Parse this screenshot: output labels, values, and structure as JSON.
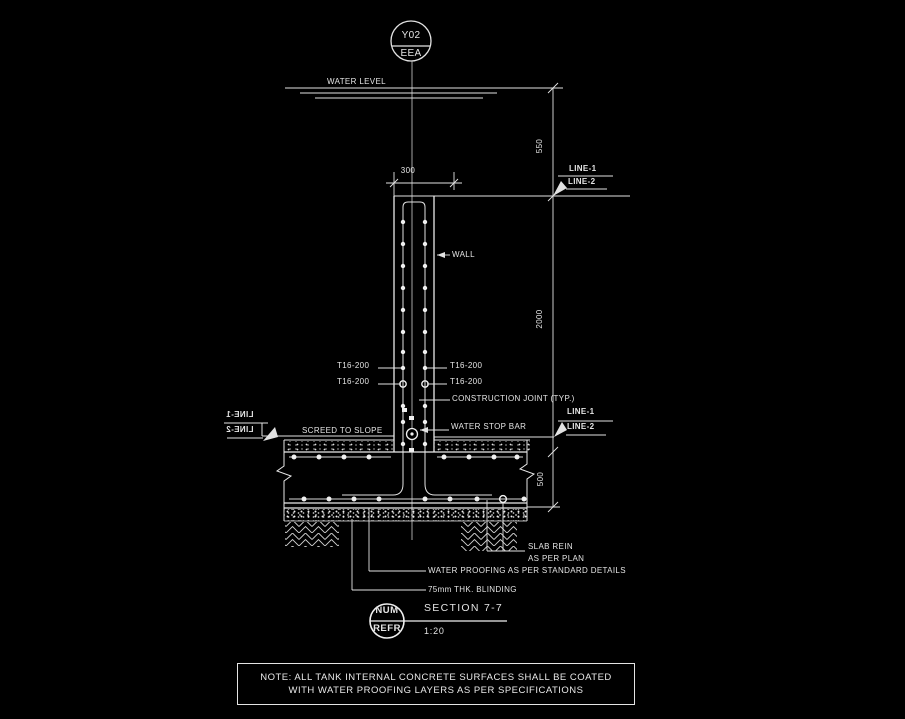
{
  "colors": {
    "background": "#000000",
    "line": "#e2e2e2",
    "text": "#e6e6e6"
  },
  "top_reference": {
    "code": "Y02",
    "zone": "EEA"
  },
  "labels": {
    "water_level": "WATER LEVEL",
    "wall": "WALL",
    "rebar": "T16-200",
    "construction_joint": "CONSTRUCTION JOINT (TYP.)",
    "water_stop_bar": "WATER STOP BAR",
    "screed_to_slope": "SCREED TO SLOPE",
    "line_1": "LINE-1",
    "line_2": "LINE-2",
    "slab_rein_line1": "SLAB REIN",
    "slab_rein_line2": "AS PER PLAN",
    "water_proofing": "WATER PROOFING AS PER STANDARD DETAILS",
    "blinding": "75mm THK. BLINDING"
  },
  "dimensions": {
    "water_level_to_wall_top": "550",
    "wall_thickness": "300",
    "wall_height": "2000",
    "slab_thickness": "500"
  },
  "title_block": {
    "bubble_top": "NUM",
    "bubble_bottom": "REFR",
    "section_title": "SECTION 7-7",
    "scale": "1:20"
  },
  "note": {
    "line1": "NOTE:  ALL TANK INTERNAL CONCRETE SURFACES SHALL BE COATED",
    "line2": "WITH WATER PROOFING LAYERS AS PER SPECIFICATIONS"
  }
}
